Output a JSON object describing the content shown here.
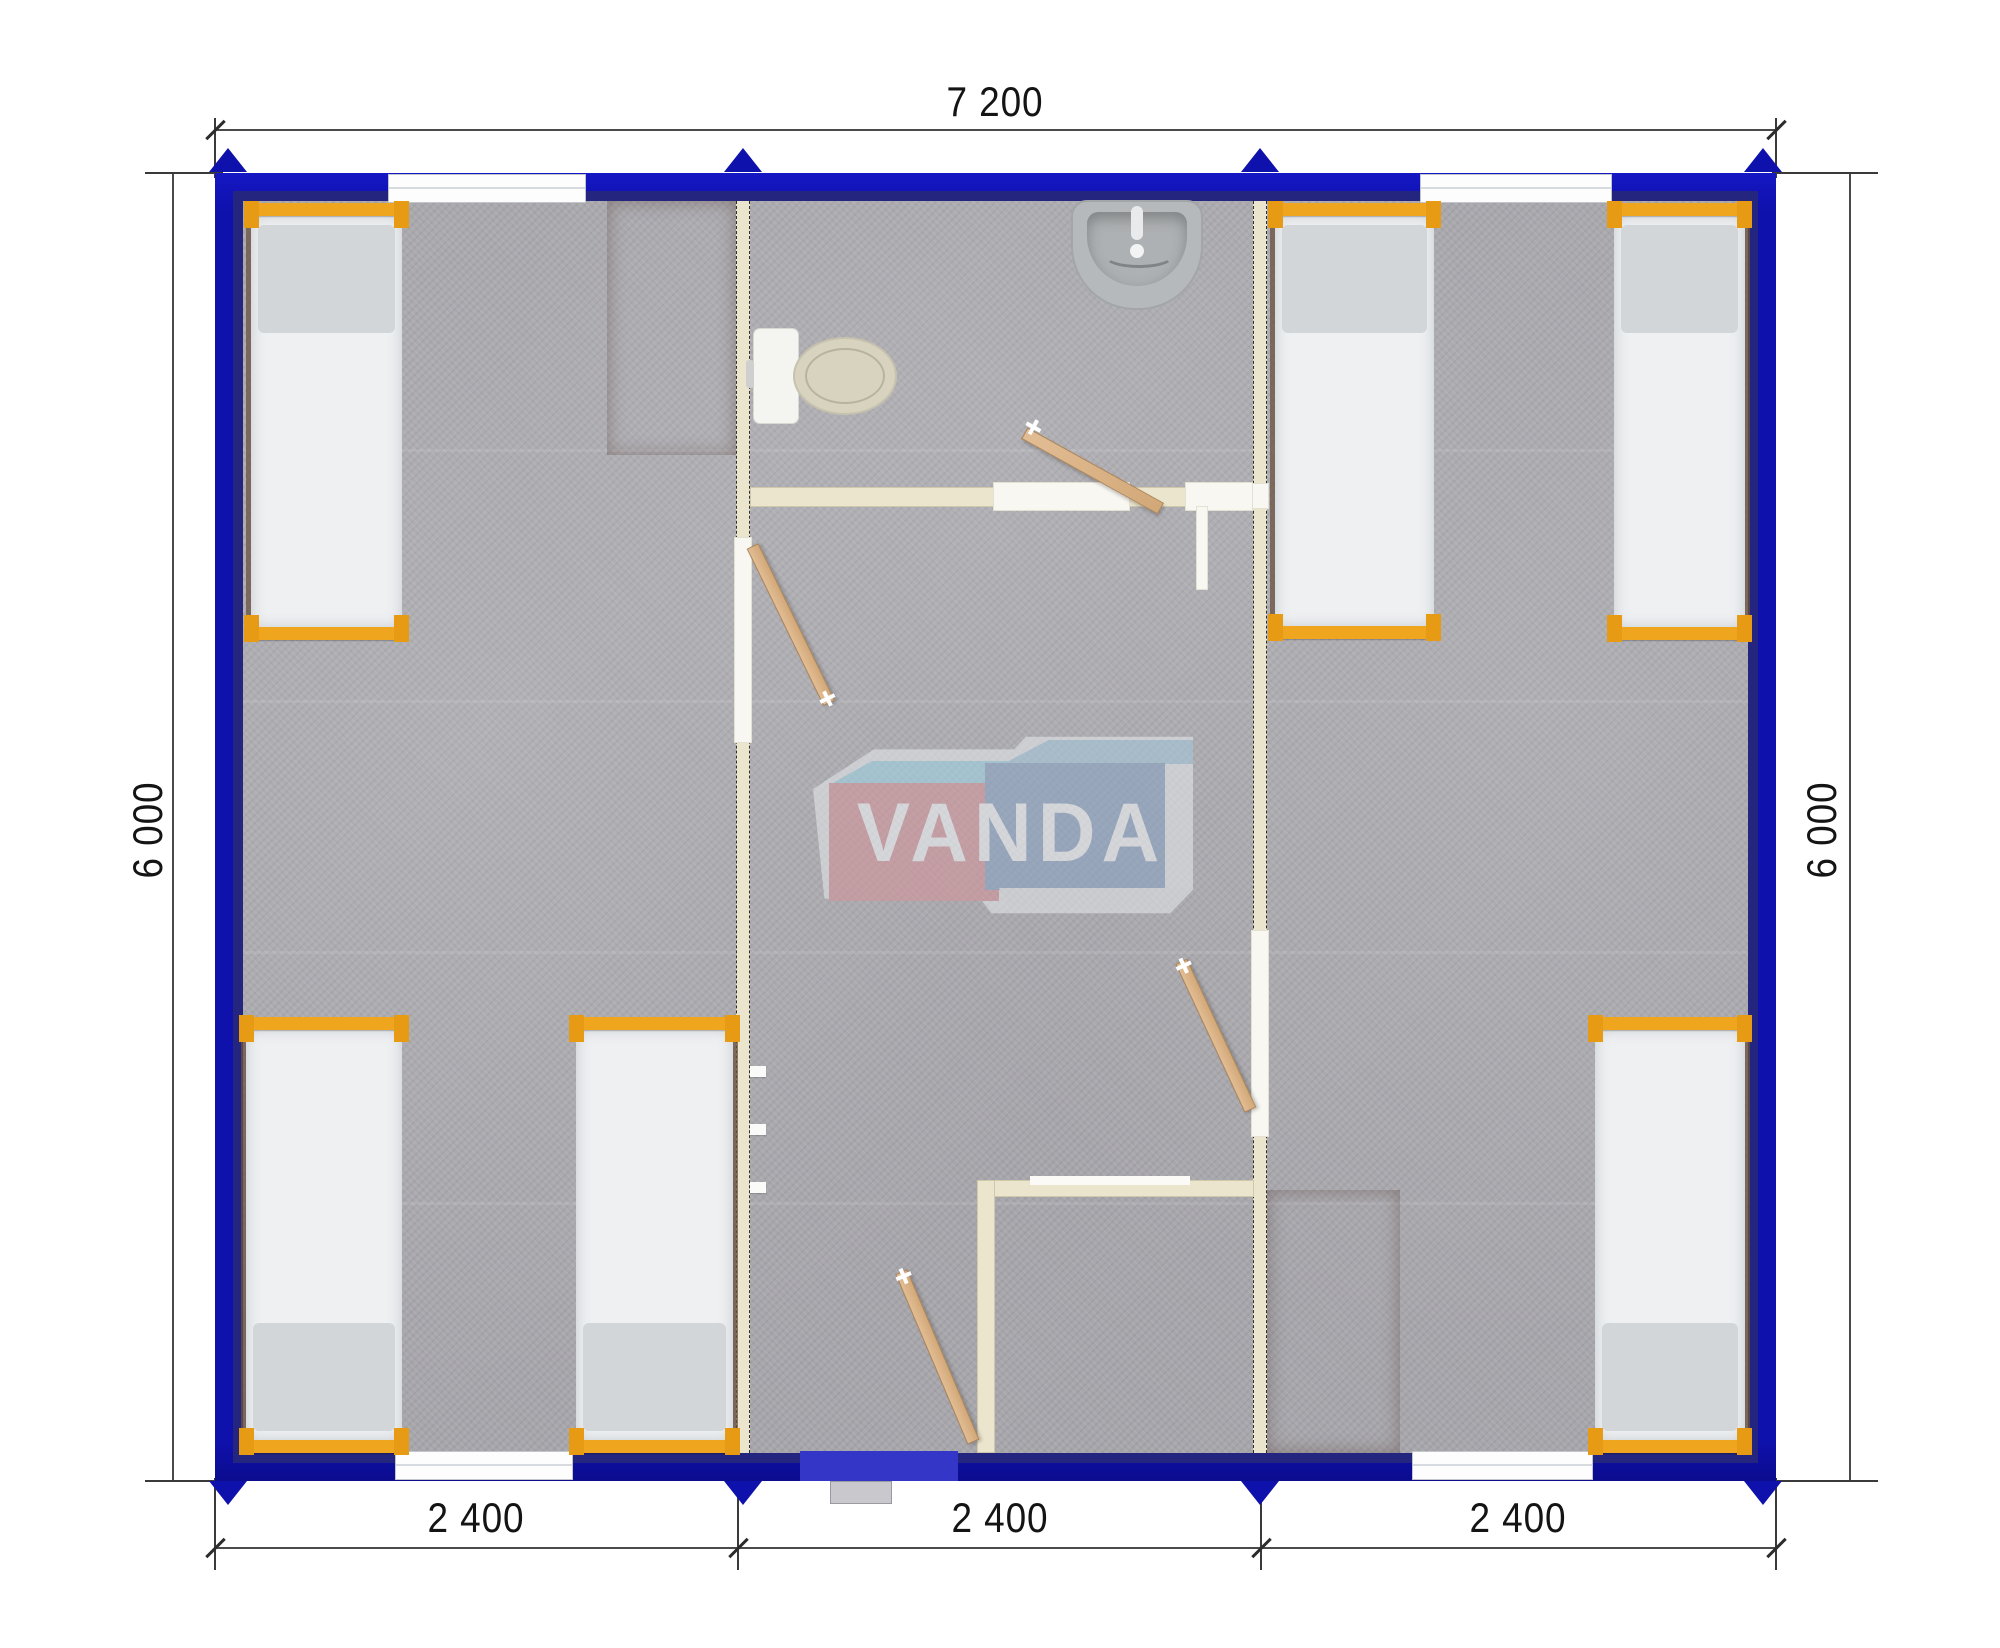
{
  "dimensions": {
    "top": "7 200",
    "left": "6 000",
    "right": "6 000",
    "bottom": [
      "2 400",
      "2 400",
      "2 400"
    ]
  },
  "logo": {
    "text": "VANDA"
  },
  "colors": {
    "wall_blue": "#0f11ac",
    "partition_cream": "#ece5cd",
    "bed_frame_orange": "#efa51d",
    "mattress_white": "#eef0f2",
    "table_brown": "#9c5a41",
    "floor_gray": "#a7a6ab",
    "logo_red": "#d2959b",
    "logo_blue": "#8aa3c3",
    "door_wood": "#d9b186"
  }
}
